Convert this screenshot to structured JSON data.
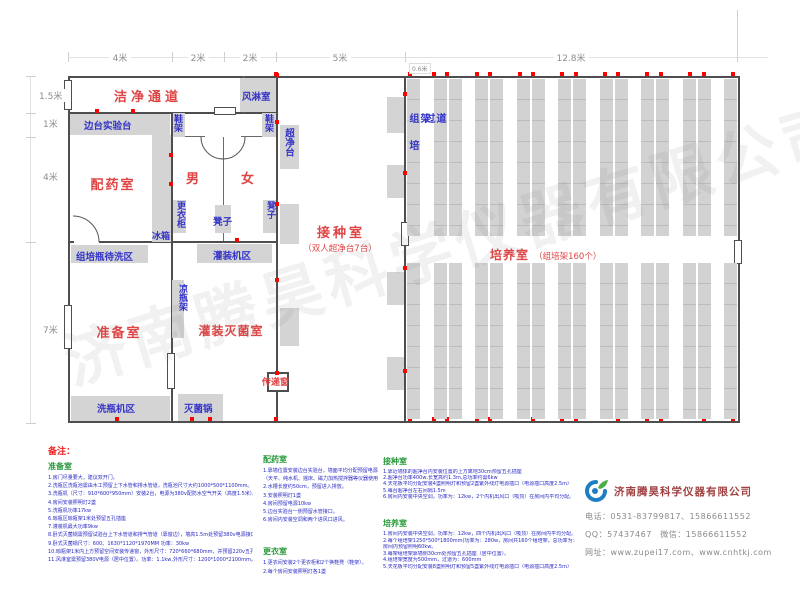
{
  "dims": {
    "top": [
      "4米",
      "2米",
      "2米",
      "5米",
      "12.8米"
    ],
    "left": [
      "1.5米",
      "1米",
      "4米",
      "7米"
    ],
    "rack_width": "0.6米"
  },
  "plan": {
    "clean_corridor": "洁净通道",
    "air_shower": "风淋室",
    "side_bench": "边台实验台",
    "shoe_rack": "鞋架",
    "clean_bench": "超净台",
    "dispensing_room": "配药室",
    "male": "男",
    "female": "女",
    "locker": "更衣柜",
    "stool": "凳子",
    "fridge": "冰箱",
    "bottle_wait_zone": "组培瓶待洗区",
    "filling_zone": "灌装机区",
    "inoculation_room": "接种室",
    "inoculation_sub": "（双人超净台7台）",
    "prep_room": "准备室",
    "cool_bottle_rack": "凉瓶架",
    "fill_sterilize_room": "灌装灭菌室",
    "bottle_washer_zone": "洗瓶机区",
    "sterilizer_pot": "灭菌锅",
    "pass_window": "传递窗",
    "culture_room": "培养室",
    "culture_sub": "（组培架160个）",
    "rack_vertical": "组培架",
    "aisle_vertical": "过道"
  },
  "watermark": "济南腾昊科学仪器有限公司",
  "notes": {
    "title": "备注：",
    "prep": {
      "title": "准备室",
      "items": [
        "1.房门尽量要大，建议双开门。",
        "2.洗瓶区洗瓶池需由木工预留上下水管和排水管道，洗瓶池尺寸大约1000*500*1100mm。",
        "3.洗瓶机（尺寸：910*600*950mm）安装2台，电源为380v配防水空气开关（高度1.5米）。",
        "4.房间安装照明灯2盏",
        "5.洗瓶机功率17kw",
        "6.晾瓶区晾瓶架1米处预留五孔插座",
        "7.灌装机最大功率9kw",
        "8.卧式灭菌锅需预留试验台上下水管道和排气管道（靠窗边），墙高1.5m处预留380v电源接口",
        "9.卧式灭菌锅尺寸：600、1630*1120*1970MM 功率：30kw",
        "10.晾瓶架1米内上方预留空间安装传递窗，外形尺寸：720*660*680mm，并预留220v五孔插座（居中位置）",
        "11.风淋室需预留380V电源（居中位置）。功率：1.1kw,外形尺寸：1200*1000*2100mm。"
      ]
    },
    "dispensing": {
      "title": "配药室",
      "items": [
        "1.靠墙位置安装边台实验台，墙面平均分配预留电源插口",
        "（天平、纯水机、摇床、磁力加热搅拌器等仪器使用）",
        "2.水槽长度约50cm，预留进入排放。",
        "3.安装照明灯1盏",
        "4.房间预留电源10kw",
        "5.边台实验台一侧预留水管接口。",
        "6.房间内安装空调和两个进风口进风。"
      ]
    },
    "changing": {
      "title": "更衣室",
      "items": [
        "1.更衣间安装2个更衣柜和2个换鞋凳（鞋架）。",
        "2.每个房间安装照明灯各1盏"
      ]
    },
    "inoculation": {
      "title": "接种室",
      "items": [
        "1.靠近墙体的超净台内安装位置的上方离地30cm预留五孔插座",
        "2.超净台功率400w,长宽高约1.3m,总功率约需6kw",
        "4.天花板平均分配安装4盏照明灯和预留2盏紫外线灯电源插口（电源插口高度2.5m）",
        "5.每台超净台左右间隔1.5m",
        "6.房间内安装中央空调，功率为：12kw，2个内机出风口（吸顶）在房间内平均分配。"
      ]
    },
    "culture": {
      "title": "培养室",
      "items": [
        "1.房间内安装中央空调，功率为：12kw，四个内机出风口（吸顶）在房间内平均分配。",
        "2.每个组培架1250*500*1800mm(功率为：280w，房间共160个组培架，总功率为：50kw，",
        "房间内预留照明60kw。",
        "3.每架组培架靠墙侧30cm处预留五孔插座（居中位置）。",
        "4.组培架宽度为500mm，过道为：600mm",
        "5.天花板平均分配安装8盏照明灯和预留5盏紫外线灯电源插口（电源插口高度2.5m）"
      ]
    }
  },
  "company": {
    "name": "济南腾昊科学仪器有限公司",
    "phone": "电话：0531-83799817、15866611552",
    "qq_wechat": "QQ：57437467　微信：15866611552",
    "web": "网址：www.zupei17.com、www.cnhtkj.com"
  }
}
